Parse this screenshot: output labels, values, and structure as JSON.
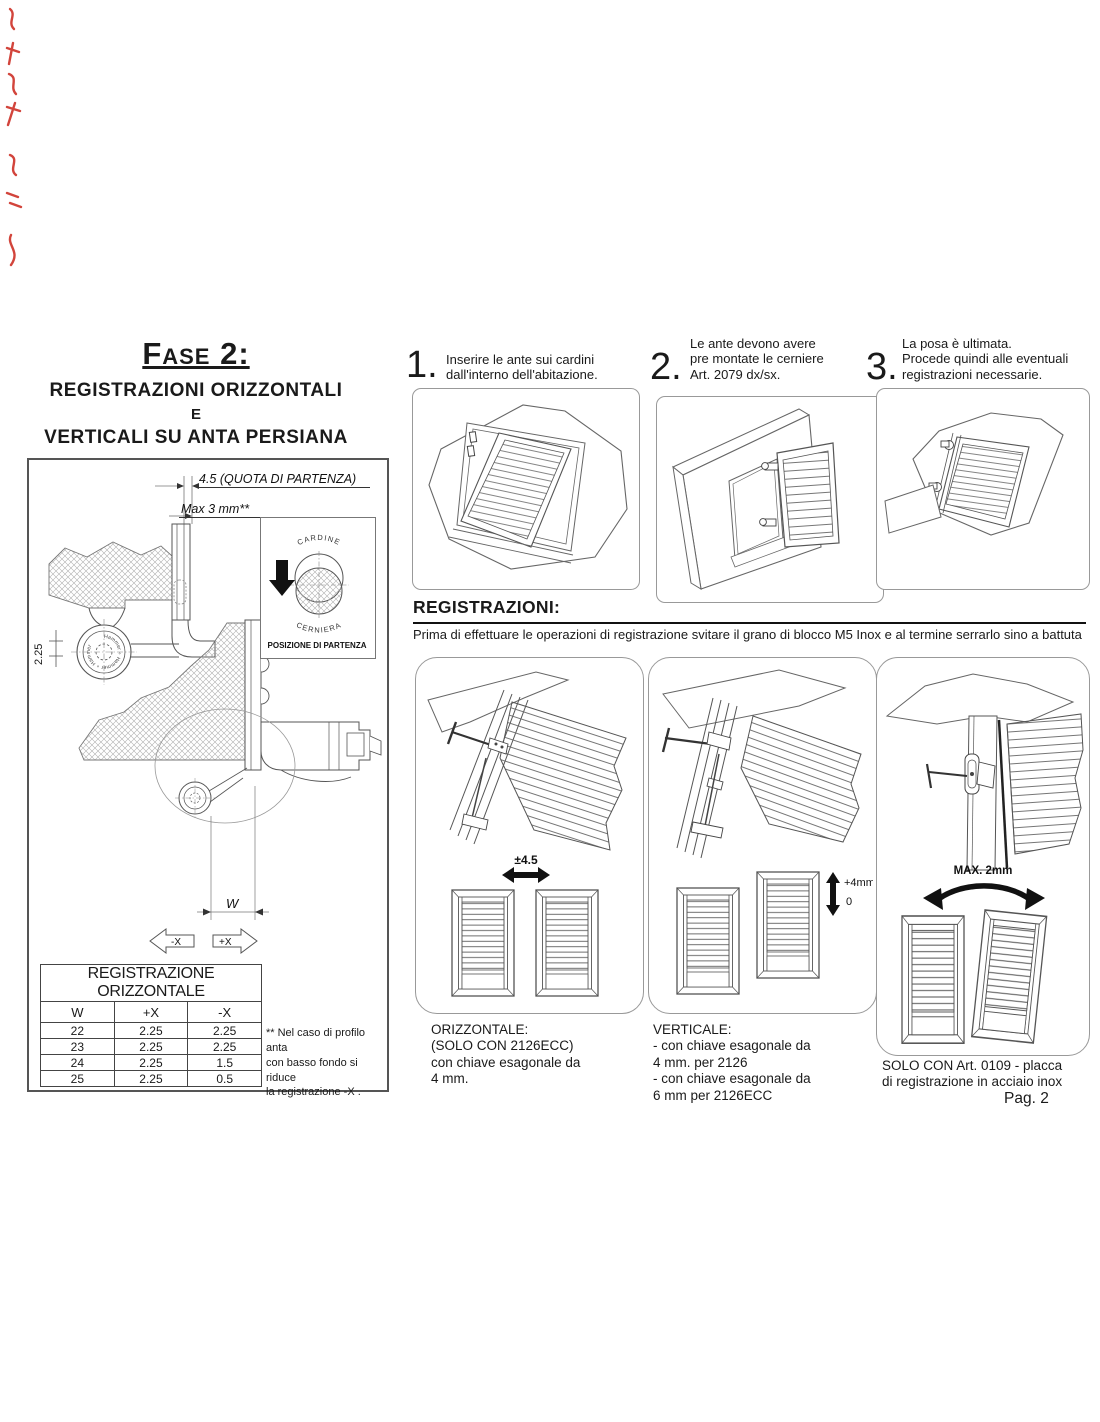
{
  "title": {
    "line1": "Fase 2:",
    "line2": "REGISTRAZIONI ORIZZONTALI",
    "line3": "E",
    "line4": "VERTICALI SU ANTA PERSIANA"
  },
  "steps": [
    {
      "number": "1.",
      "text": "Inserire le ante sui cardini\ndall'interno dell'abitazione."
    },
    {
      "number": "2.",
      "text": "Le ante devono avere\npre montate le cerniere\nArt. 2079 dx/sx."
    },
    {
      "number": "3.",
      "text": "La posa è ultimata.\nProcede quindi alle eventuali\nregistrazioni necessarie."
    }
  ],
  "registrazioni": {
    "heading": "REGISTRAZIONI:",
    "intro": "Prima di effettuare le operazioni di registrazione svitare il grano di blocco M5 Inox e al termine serrarlo sino a battuta"
  },
  "panels": {
    "p1": {
      "dim": "±4.5",
      "caption": "ORIZZONTALE:\n(SOLO CON 2126ECC)\ncon chiave esagonale da\n4 mm."
    },
    "p2": {
      "dim_top": "+4mm",
      "dim_bottom": "0",
      "caption": "VERTICALE:\n- con chiave esagonale da\n4 mm. per 2126\n- con chiave esagonale da\n6 mm per 2126ECC"
    },
    "p3": {
      "dim": "MAX. 2mm",
      "caption": "SOLO CON Art. 0109 - placca\ndi registrazione in acciaio inox",
      "page_number": "Pag. 2"
    }
  },
  "diagram": {
    "dim_quota": "4.5 (QUOTA DI PARTENZA)",
    "dim_max": "Max 3 mm**",
    "dim_225": "2.25",
    "dim_w": "W",
    "arrow_left": "-X",
    "arrow_right": "+X",
    "hinge_brand": "Hammer ∘ Hammer ∘ Hammer",
    "inset": {
      "top_label": "CARDINE",
      "bottom_label": "CERNIERA",
      "caption": "POSIZIONE DI PARTENZA"
    }
  },
  "table": {
    "title": "REGISTRAZIONE ORIZZONTALE",
    "headers": [
      "W",
      "+X",
      "-X"
    ],
    "rows": [
      [
        "22",
        "2.25",
        "2.25"
      ],
      [
        "23",
        "2.25",
        "2.25"
      ],
      [
        "24",
        "2.25",
        "1.5"
      ],
      [
        "25",
        "2.25",
        "0.5"
      ]
    ],
    "footnote": "** Nel caso di profilo anta\ncon basso fondo si riduce\nla registrazione -X ."
  }
}
